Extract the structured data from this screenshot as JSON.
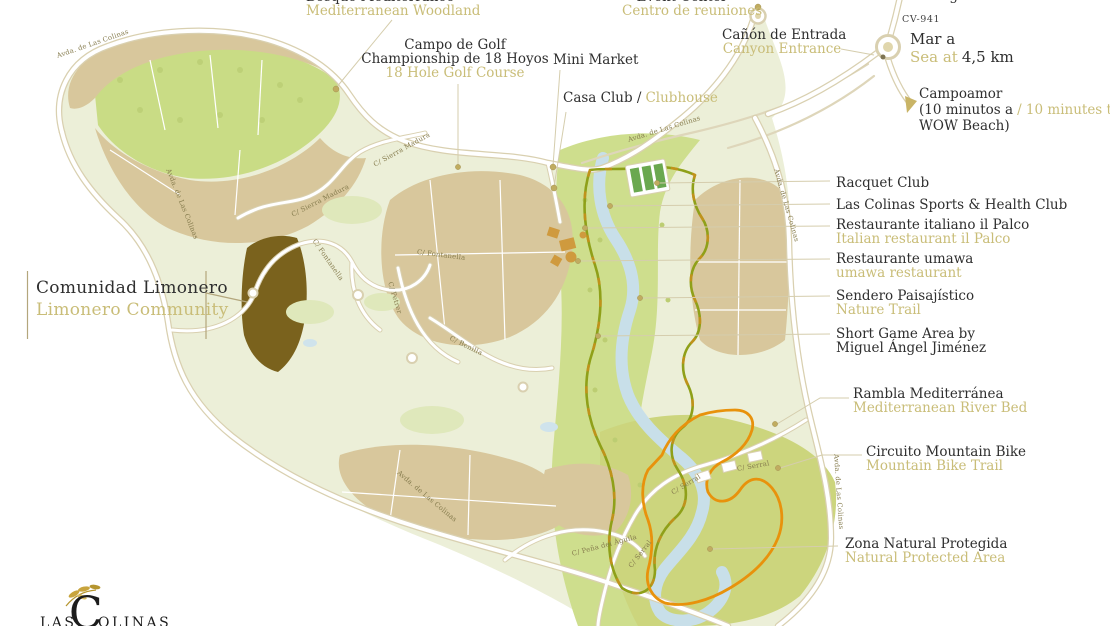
{
  "labels": {
    "bosque": {
      "es": "Bosque Mediterráneo",
      "en": "Mediterranean Woodland"
    },
    "campo_golf": {
      "es_line1": "Campo de Golf",
      "es_line2": "Championship de 18 Hoyos",
      "en": "18 Hole Golf Course"
    },
    "mini_market": {
      "es": "Mini Market"
    },
    "casa_club": {
      "es": "Casa Club /",
      "en": "Clubhouse"
    },
    "event_center": {
      "en": "Event Center",
      "es": "Centro de reuniones"
    },
    "canyon": {
      "es": "Cañón de Entrada",
      "en": "Canyon Entrance"
    },
    "road_cv941": "CV-941",
    "sea": {
      "es": "Mar a",
      "en": "Sea at",
      "distance": "4,5 km"
    },
    "san_miguel": "San Miguel de Salinas",
    "campoamor": {
      "line1": "Campoamor",
      "line2_es": "(10 minutos a",
      "line2_en": "/ 10 minutes to",
      "line3": "WOW Beach)"
    },
    "racquet_club": "Racquet Club",
    "sports_club": "Las Colinas Sports & Health Club",
    "il_palco": {
      "es": "Restaurante italiano il Palco",
      "en": "Italian restaurant il Palco"
    },
    "umawa": {
      "es": "Restaurante umawa",
      "en": "umawa restaurant"
    },
    "sendero": {
      "es": "Sendero Paisajístico",
      "en": "Nature Trail"
    },
    "short_game": {
      "line1": "Short Game Area by",
      "line2": "Miguel Ángel Jiménez"
    },
    "rambla": {
      "es": "Rambla Mediterránea",
      "en": "Mediterranean River Bed"
    },
    "mountain_bike": {
      "es": "Circuito Mountain Bike",
      "en": "Mountain Bike Trail"
    },
    "natural_area": {
      "es": "Zona Natural Protegida",
      "en": "Natural Protected Area"
    },
    "limonero": {
      "es": "Comunidad Limonero",
      "en": "Limonero Community"
    }
  },
  "streets": {
    "avda": "Avda. de Las Colinas",
    "sierra_madura": "C/ Sierra Madura",
    "fontanella": "C/ Fontanella",
    "petrer": "C/ Petrer",
    "benilla": "C/ Benilla",
    "serral": "C/ Serral",
    "pena_aguila": "C/ Peña del Águila"
  },
  "logo": {
    "prefix": "LAS",
    "initial": "C",
    "suffix": "OLINAS"
  },
  "colors": {
    "label_ink": "#2f2f2f",
    "label_gold": "#c9bd78",
    "street_ink": "#867c4e",
    "leader": "#d5cdad",
    "parcel_tan": "#d8c79c",
    "woodland_green": "#c9dc85",
    "golf_green": "#ecefd8",
    "corridor_green": "#cede8d",
    "protected_green": "#ccd57d",
    "river_blue": "#c8dfe9",
    "road_casing": "#d9d0b0",
    "road_fill": "#ffffff",
    "bike_trail_orange": "#e8920c",
    "nature_trail_olive": "#8fa019",
    "limonero_brown": "#7a621d",
    "marker_gold": "#c0ac60",
    "logo_ink": "#1c1c1c",
    "logo_leaf_gold": "#c8a43d"
  }
}
